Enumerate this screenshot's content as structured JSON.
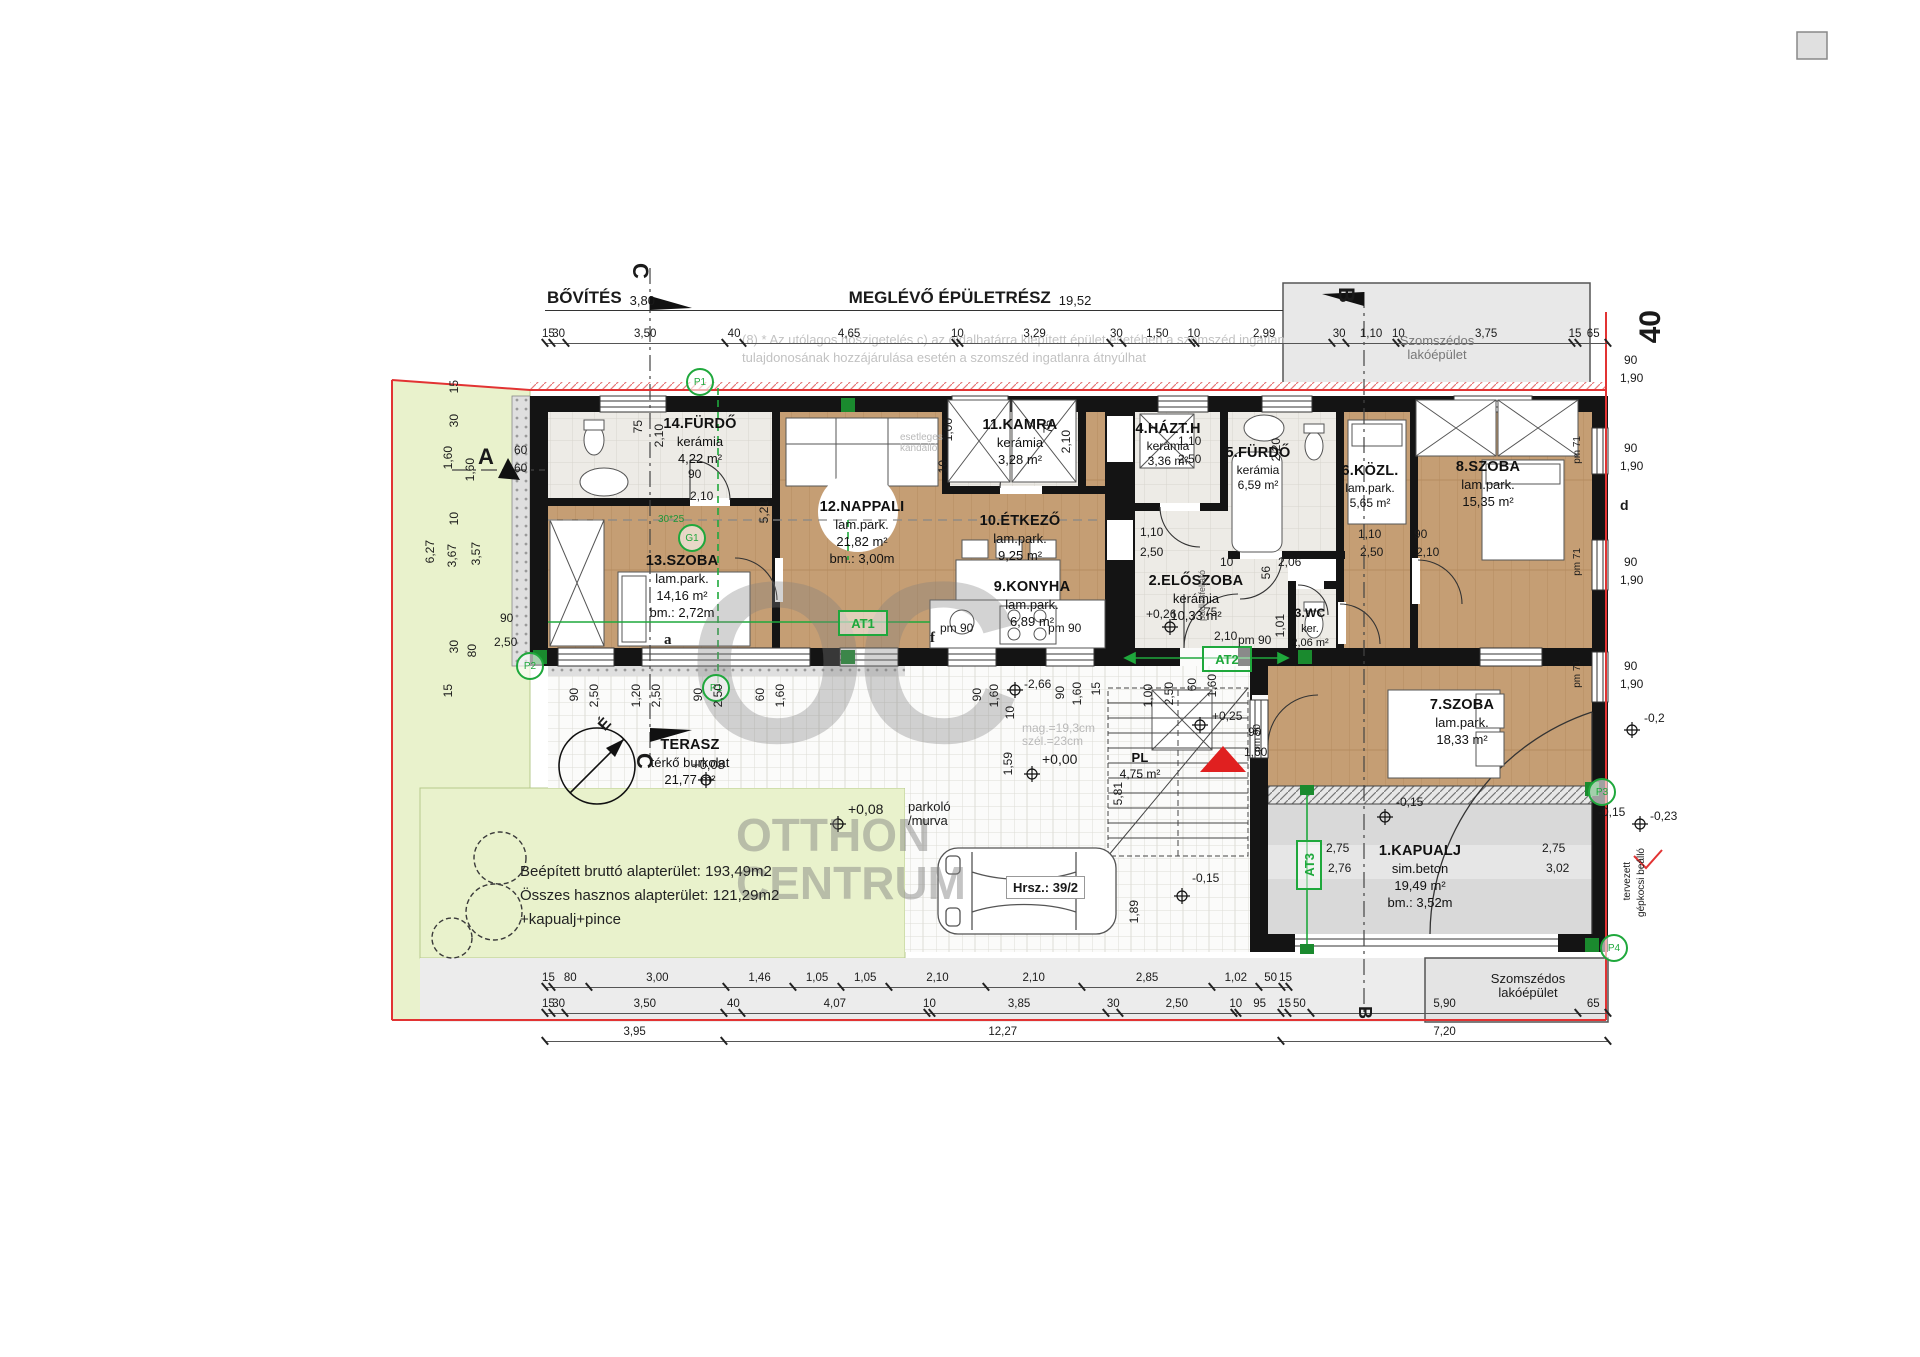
{
  "header": {
    "bovites_label": "BŐVÍTÉS",
    "bovites_value": "3,80",
    "meglevo_label": "MEGLÉVŐ ÉPÜLETRÉSZ",
    "meglevo_value": "19,52",
    "note1": "(8) *  Az utólagos hőszigetelés c) az oldalhatárra kiépített épület esetében a szomszéd ingatlan",
    "note2": "tulajdonosának hozzájárulása esetén a szomszéd ingatlanra átnyúlhat"
  },
  "neighbor": {
    "line1": "Szomszédos",
    "line2": "lakóépület"
  },
  "plot_number": "40",
  "rooms": [
    {
      "name": "14.FÜRDŐ",
      "material": "kerámia",
      "area": "4,22 m²"
    },
    {
      "name": "13.SZOBA",
      "material": "lam.park.",
      "area": "14,16 m²",
      "height": "bm.: 2,72m"
    },
    {
      "name": "12.NAPPALI",
      "material": "lam.park.",
      "area": "21,82 m²",
      "height": "bm.: 3,00m"
    },
    {
      "name": "11.KAMRA",
      "material": "kerámia",
      "area": "3,28 m²"
    },
    {
      "name": "10.ÉTKEZŐ",
      "material": "lam.park.",
      "area": "9,25 m²"
    },
    {
      "name": "9.KONYHA",
      "material": "lam.park.",
      "area": "6,89 m²"
    },
    {
      "name": "4.HÁZT.H",
      "material": "kerámia",
      "area": "3,36 m²"
    },
    {
      "name": "5.FÜRDŐ",
      "material": "kerámia",
      "area": "6,59 m²"
    },
    {
      "name": "2.ELŐSZOBA",
      "material": "kerámia",
      "area": "10,33 m²"
    },
    {
      "name": "3.WC",
      "material": "ker.",
      "area": "2,06 m²"
    },
    {
      "name": "6.KÖZL.",
      "material": "lam.park.",
      "area": "5,65 m²"
    },
    {
      "name": "8.SZOBA",
      "material": "lam.park.",
      "area": "15,35 m²"
    },
    {
      "name": "7.SZOBA",
      "material": "lam.park.",
      "area": "18,33 m²"
    },
    {
      "name": "TERASZ",
      "material": "térkő burkolat",
      "area": "21,77 m²"
    },
    {
      "name": "1.KAPUALJ",
      "material": "sim.beton",
      "area": "19,49 m²",
      "height": "bm.: 3,52m"
    },
    {
      "name": "PL",
      "area": "4,75 m²"
    }
  ],
  "site": {
    "parking1": "parkoló",
    "parking2": "/murva",
    "hrsz": "Hrsz.: 39/2",
    "sum1": "Beépített bruttó alapterület: 193,49m2",
    "sum2": "Összes hasznos alapterület: 121,29m2",
    "sum3": "+kapualj+pince",
    "stair1": "mag.=19,3cm",
    "stair2": "szél.=23cm",
    "kandallo1": "esetleges",
    "kandallo2": "kandalló",
    "padlas": "padlásfeljáró",
    "carport1": "tervezett",
    "carport2": "gépkocsi beálló",
    "door_a": "a",
    "door_f": "f"
  },
  "markers": {
    "a": "A",
    "b": "B",
    "c": "C",
    "d": "d",
    "north": "É",
    "p1": "P1",
    "p2": "P2",
    "p3": "P3",
    "p4": "P4",
    "g1": "G1",
    "at1": "AT1",
    "at2": "AT2",
    "at3": "AT3",
    "size_note": "30*25"
  },
  "levels": {
    "a": "+0,08",
    "b": "+0,00",
    "c": "+0,26",
    "d": "+0,25",
    "e": "-0,15",
    "f": "-0,15",
    "g": "-0,2",
    "h": "-0,15",
    "i": "-0,23",
    "j": "+0,08"
  },
  "watermark": {
    "monogram": "OC",
    "line1": "OTTHON",
    "line2": "CENTRUM"
  },
  "dims": {
    "top_chain": [
      "15",
      "30",
      "3,50",
      "40",
      "4,65",
      "10",
      "3,29",
      "30",
      "1,50",
      "10",
      "2,99",
      "30",
      "1,10",
      "10",
      "3,75",
      "15",
      "65"
    ],
    "bottom_a": [
      "15",
      "80",
      "3,00",
      "1,46",
      "1,05",
      "1,05",
      "2,10",
      "2,10",
      "2,85",
      "1,02",
      "50",
      "15"
    ],
    "bottom_b": [
      "15",
      "30",
      "3,50",
      "40",
      "4,07",
      "10",
      "3,85",
      "30",
      "2,50",
      "10",
      "95",
      "15",
      "50",
      "5,90",
      "65"
    ],
    "bottom_c": [
      "3,95",
      "12,27",
      "7,20"
    ],
    "left": [
      "15",
      "30",
      "1,60",
      "1,60",
      "10",
      "6,27",
      "3,67",
      "3,57",
      "30",
      "80",
      "15"
    ],
    "right": [
      "90",
      "1,90",
      "90",
      "1,90",
      "90",
      "1,90",
      "90",
      "1,90"
    ],
    "terasz_row": [
      "90",
      "2,50",
      "1,20",
      "2,50",
      "90",
      "2,50",
      "60",
      "1,60"
    ],
    "pm71": "pm 71",
    "pm90": "pm 90",
    "misc": [
      "5,21",
      "1,00",
      "10",
      "75",
      "2,10",
      "75",
      "2,10",
      "90",
      "2,10",
      "60",
      "60",
      "90",
      "2,50",
      "1,10",
      "2,50",
      "1,10",
      "2,50",
      "2,20",
      "56",
      "10",
      "2,06",
      "1,01",
      "75",
      "2,10",
      "1,10",
      "2,50",
      "90",
      "2,10",
      "90",
      "1,60",
      "10",
      "1,59",
      "5,81",
      "1,89",
      "1,00",
      "2,50",
      "60",
      "1,60",
      "90",
      "1,60",
      "2,75",
      "2,76",
      "2,75",
      "3,02",
      "-2,66",
      "90",
      "1,60",
      "15"
    ]
  }
}
